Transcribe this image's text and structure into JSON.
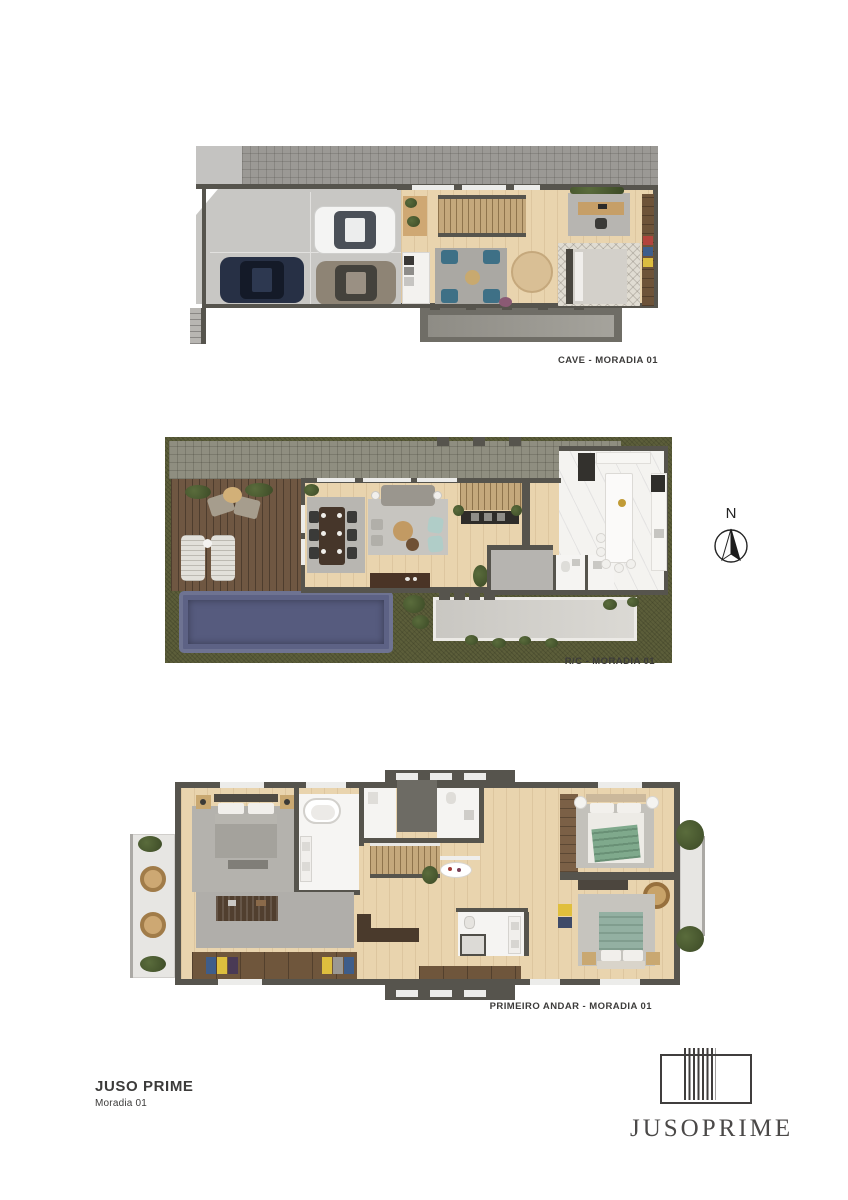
{
  "plans": [
    {
      "caption": "CAVE - MORADIA 01"
    },
    {
      "caption": "R/C - MORADIA 01"
    },
    {
      "caption": "PRIMEIRO ANDAR - MORADIA 01"
    }
  ],
  "compass": {
    "label": "N"
  },
  "footer": {
    "title": "JUSO PRIME",
    "subtitle": "Moradia 01"
  },
  "logo": {
    "wordmark": "JUSOPRIME"
  },
  "colors": {
    "wall": "#56544d",
    "wood_floor": "#e9d4ae",
    "grass": "#5c5e3a",
    "pool_water": "#5d6285",
    "deck_wood": "#6f5742",
    "paving": "#9b9995",
    "marble": "#f4f3f0",
    "teal_chair": "#3e7086",
    "accent_yellow": "#ddbe3e",
    "accent_blue": "#3e5d8a",
    "accent_red": "#b2433c",
    "text": "#3c3b3a"
  }
}
